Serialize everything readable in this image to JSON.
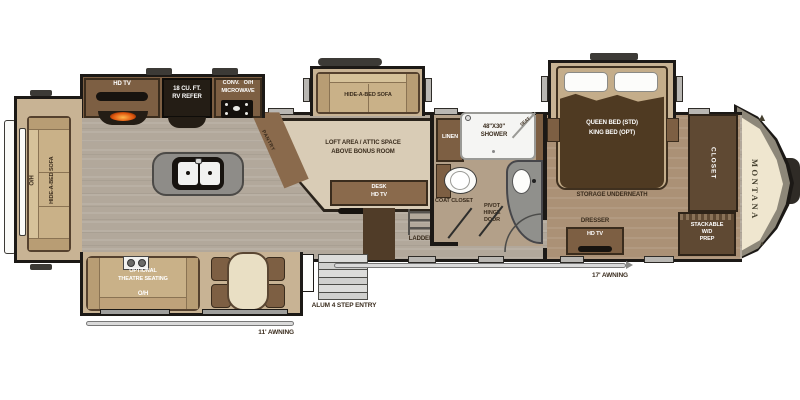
{
  "colors": {
    "wall": "#1c1916",
    "floor_main": "#b2a89b",
    "floor_bedroom": "#ab9176",
    "floor_slide": "#c8b394",
    "cabinet_brown": "#7d5f43",
    "dark_brown": "#5f4933",
    "sofa_tan": "#c9b188",
    "loft_beige": "#d9ccb6",
    "appliance_black": "#241d15",
    "counter_gray": "#8e8c88",
    "nose_olive": "#8d8779",
    "nose_cream": "#efe6cf",
    "label_dark": "#3a2c1d",
    "label_light": "#ffffff"
  },
  "brand": {
    "name": "MONTANA"
  },
  "icons": {
    "mountain_logo": "▲"
  },
  "rear_slide": {
    "overhead": "O/H",
    "sofa": "HIDE-A-BED SOFA"
  },
  "kitchen": {
    "tv": "HD TV",
    "refer_line1": "18 CU. FT.",
    "refer_line2": "RV REFER",
    "conv": "CONV.",
    "overhead": "O/H",
    "microwave": "MICROWAVE",
    "pantry": "PANTRY"
  },
  "mid_slide": {
    "sofa": "HIDE-A-BED SOFA"
  },
  "loft": {
    "line1": "LOFT AREA / ATTIC SPACE",
    "line2": "ABOVE BONUS ROOM",
    "desk": "DESK",
    "desk_tv": "HD TV",
    "ladder": "LADDER"
  },
  "bathroom": {
    "linen": "LINEN",
    "shower_size": "48\"X30\"",
    "shower": "SHOWER",
    "seat": "SEAT",
    "coat_closet": "COAT CLOSET",
    "pivot_line1": "PIVOT",
    "pivot_line2": "HINGE",
    "pivot_line3": "DOOR"
  },
  "bedroom": {
    "bed_line1": "QUEEN BED (STD)",
    "bed_line2": "KING BED (OPT)",
    "storage": "STORAGE UNDERNEATH",
    "dresser": "DRESSER",
    "dresser_tv": "HD TV",
    "closet": "CLOSET",
    "wd_line1": "STACKABLE",
    "wd_line2": "W/D",
    "wd_line3": "PREP"
  },
  "living_slide": {
    "theatre_line1": "OPTIONAL",
    "theatre_line2": "THEATRE SEATING",
    "overhead": "O/H"
  },
  "exterior": {
    "entry_label": "ALUM 4 STEP ENTRY",
    "awning_rear": "11' AWNING",
    "awning_main": "17' AWNING"
  }
}
